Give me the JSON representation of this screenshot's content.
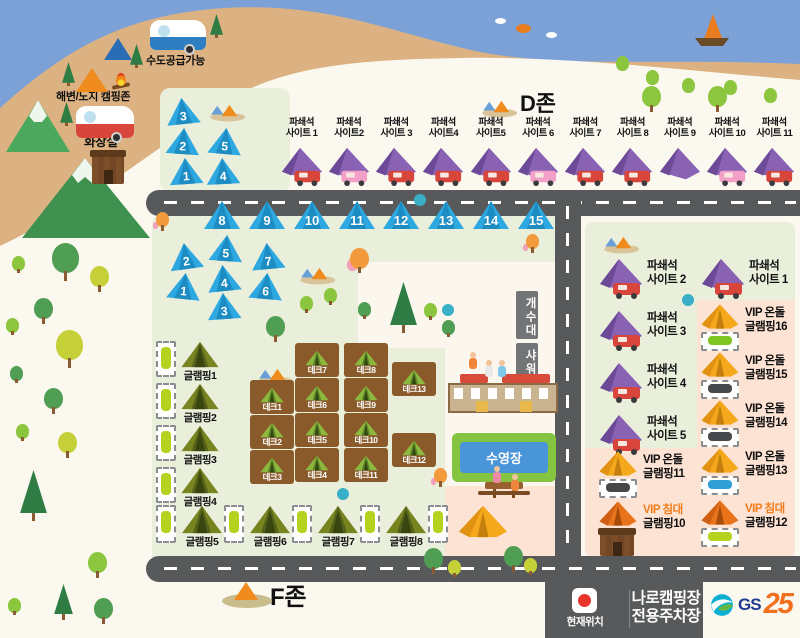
{
  "colors": {
    "sea": "#7ba1d7",
    "sand": "#dcb282",
    "land": "#fbf8f0",
    "zone_green": "#e9efda",
    "vip_pink": "#fde3d3",
    "road": "#58595b",
    "tent_blue": "#2da8e0",
    "tent_purple": "#8a62b4",
    "vip_orange": "#f6a81c",
    "vip_bed_orange": "#e8731a",
    "deck_brown": "#8a5a2b",
    "glamp_olive": "#77841f",
    "pool_blue": "#4a94d8",
    "marker_red": "#e8342a",
    "gs_blue": "#1f3a8f",
    "gs_orange": "#f26f1e"
  },
  "beach": {
    "water_supply": "수도공급가능",
    "camp_zone": "해변/노지 캠핑존",
    "toilet": "화장실"
  },
  "zone_a": {
    "label": "A존",
    "tents": [
      "3",
      "2",
      "1",
      "5",
      "4"
    ]
  },
  "zone_d": {
    "label": "D존",
    "sites": [
      {
        "l1": "파쇄석",
        "l2": "사이트 1"
      },
      {
        "l1": "파쇄석",
        "l2": "사이트2"
      },
      {
        "l1": "파쇄석",
        "l2": "사이트 3"
      },
      {
        "l1": "파쇄석",
        "l2": "사이트4"
      },
      {
        "l1": "파쇄석",
        "l2": "사이트5"
      },
      {
        "l1": "파쇄석",
        "l2": "사이트 6"
      },
      {
        "l1": "파쇄석",
        "l2": "사이트 7"
      },
      {
        "l1": "파쇄석",
        "l2": "사이트 8"
      },
      {
        "l1": "파쇄석",
        "l2": "사이트 9"
      },
      {
        "l1": "파쇄석",
        "l2": "사이트 10"
      },
      {
        "l1": "파쇄석",
        "l2": "사이트 11"
      }
    ]
  },
  "zone_c": {
    "label": "C존",
    "desc1": "파쇄석존",
    "desc2": "1~15번",
    "row_tents": [
      "8",
      "9",
      "10",
      "11",
      "12",
      "13",
      "14",
      "15"
    ],
    "cluster_tents": [
      "2",
      "5",
      "7",
      "1",
      "4",
      "6",
      "3"
    ]
  },
  "zone_b": {
    "label": "B존",
    "left_sites": [
      {
        "l1": "파쇄석",
        "l2": "사이트 2"
      },
      {
        "l1": "파쇄석",
        "l2": "사이트 3"
      },
      {
        "l1": "파쇄석",
        "l2": "사이트 4"
      },
      {
        "l1": "파쇄석",
        "l2": "사이트 5"
      }
    ],
    "right_site": {
      "l1": "파쇄석",
      "l2": "사이트 1"
    },
    "vip_right": [
      {
        "l1": "VIP 온돌",
        "l2": "글램핑16"
      },
      {
        "l1": "VIP 온돌",
        "l2": "글램핑15"
      },
      {
        "l1": "VIP 온돌",
        "l2": "글램핑14"
      },
      {
        "l1": "VIP 온돌",
        "l2": "글램핑13"
      },
      {
        "l1": "VIP 침대",
        "l2": "글램핑12"
      }
    ],
    "vip11": {
      "l1": "VIP 온돌",
      "l2": "글램핑11"
    },
    "vip10": {
      "l1": "VIP 침대",
      "l2": "글램핑10"
    },
    "toilet": {
      "l1": "글램핑 존",
      "l2": "화장실"
    }
  },
  "zone_e": {
    "label": "E존",
    "col1": [
      "데크1",
      "데크2",
      "데크3"
    ],
    "col2": [
      "데크7",
      "데크6",
      "데크5",
      "데크4"
    ],
    "col3": [
      "데크8",
      "데크9",
      "데크10",
      "데크11"
    ],
    "col4": [
      "데크13",
      "데크12"
    ]
  },
  "glamping": {
    "left": [
      "글램핑1",
      "글램핑2",
      "글램핑3",
      "글램핑4"
    ],
    "bottom": [
      "글램핑5",
      "글램핑6",
      "글램핑7",
      "글램핑8"
    ],
    "vip9": {
      "l1": "VIP 온돌",
      "l2": "글램핑9"
    }
  },
  "facilities": {
    "sink": "개수대",
    "shower": "샤워장",
    "guesthouse": "게스트하우스/관리동",
    "pool": "수영장"
  },
  "zone_f": {
    "label": "F존"
  },
  "footer": {
    "current_location": "현재위치",
    "parking_line1": "나로캠핑장",
    "parking_line2": "전용주차장",
    "gs": "GS",
    "gs_num": "25"
  }
}
